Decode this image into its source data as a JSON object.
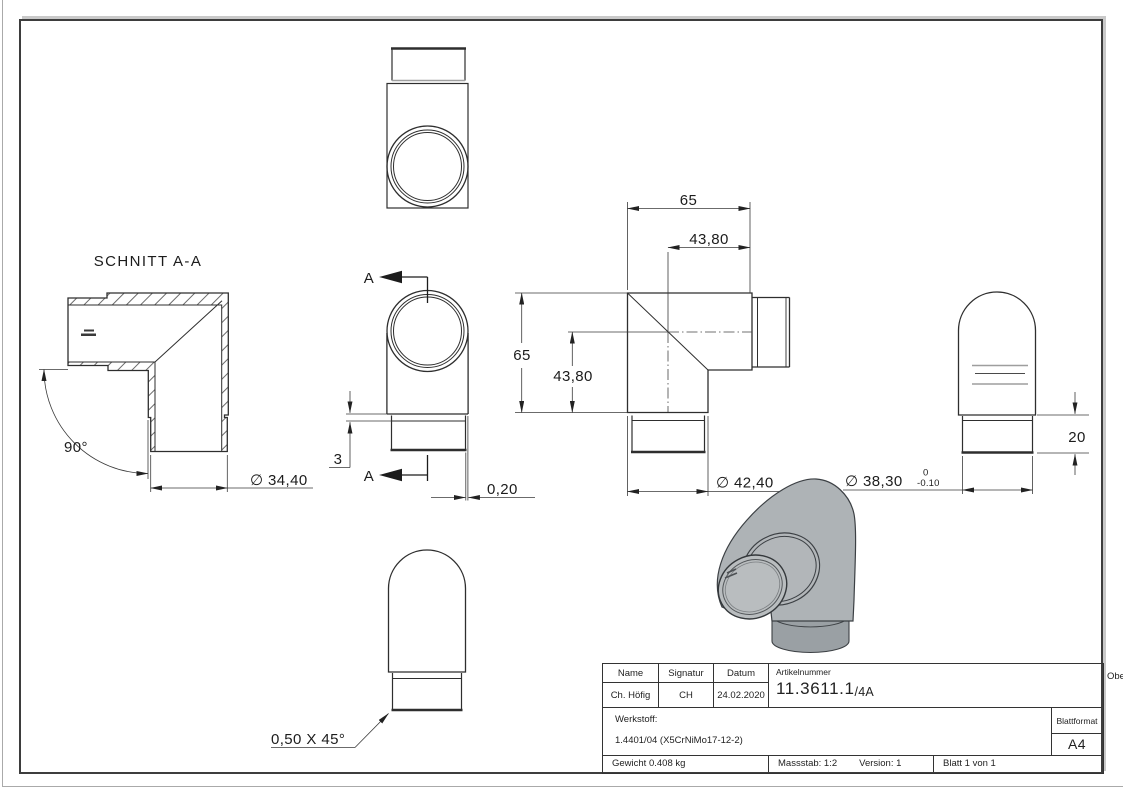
{
  "views": {
    "section": {
      "title": "SCHNITT A-A",
      "angle": "90°",
      "diameter": "∅ 34,40"
    },
    "front": {
      "cut_label": "A",
      "offset": "3",
      "edge_gap": "0,20"
    },
    "profile": {
      "width_outer": "65",
      "width_inner": "43,80",
      "height_outer": "65",
      "height_inner": "43,80",
      "diameter": "∅ 42,40"
    },
    "end": {
      "diameter": "∅ 38,30",
      "tolerance_upper": "0",
      "tolerance_lower": "-0.10",
      "spigot_length": "20"
    },
    "back": {
      "chamfer": "0,50 X 45°"
    }
  },
  "title_block": {
    "col_name": {
      "header": "Name",
      "value": "Ch. Höfig"
    },
    "col_signatur": {
      "header": "Signatur",
      "value": "CH"
    },
    "col_datum": {
      "header": "Datum",
      "value": "24.02.2020"
    },
    "artikelnummer": {
      "label": "Artikelnummer",
      "value": "11.3611.1",
      "suffix": "/4A"
    },
    "oberflaeche": {
      "label": "Oberfläche:",
      "value": "Geschliffen Korn 240"
    },
    "werkstoff": {
      "label": "Werkstoff:",
      "value": "1.4401/04 (X5CrNiMo17-12-2)"
    },
    "blattformat": {
      "label": "Blattformat",
      "value": "A4"
    },
    "gewicht": "Gewicht 0.408 kg",
    "massstab": "Massstab: 1:2",
    "version": "Version: 1",
    "blatt": "Blatt 1 von 1"
  },
  "colors": {
    "line": "#2e2e2e",
    "dim_line": "#3a3a3a",
    "frame": "#3d3d3d",
    "light_edge": "#9e9e9e",
    "render_body": "#aeb3b6",
    "render_face": "#b9bdbf",
    "render_dark": "#9aa0a4"
  }
}
